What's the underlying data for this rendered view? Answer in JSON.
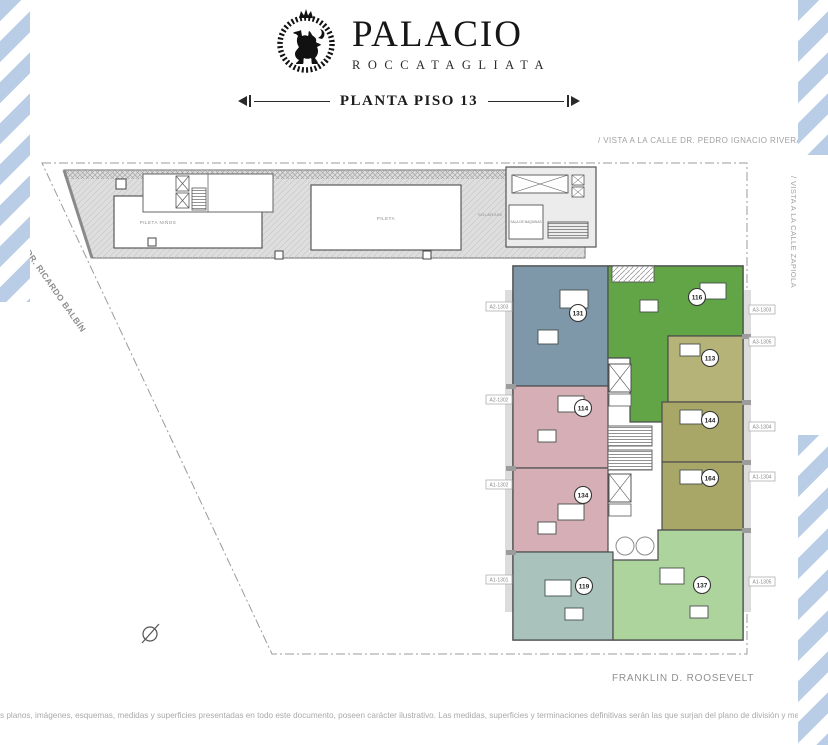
{
  "colors": {
    "stripe-blue": "#b9cde6",
    "ink": "#1d1d1b",
    "muted-gray": "#a0a0a0",
    "terrace-gray": "#dedede"
  },
  "header": {
    "brand_name": "PALACIO",
    "brand_subtitle": "ROCCATAGLIATA",
    "plan_title": "PLANTA PISO 13"
  },
  "streets": {
    "top": "/ VISTA A LA CALLE DR. PEDRO IGNACIO RIVERA",
    "right": "/ VISTA A LA CALLE ZAPIOLA",
    "left": "AV. DR. RICARDO BALBÍN",
    "bottom": "FRANKLIN D. ROOSEVELT"
  },
  "terrace": {
    "kids_pool_label": "PILETA NIÑOS",
    "pool_label": "PILETA",
    "solarium_label": "SOLARIUM",
    "machine_room_label": "SALA DE MAQUINAS"
  },
  "plan": {
    "units": [
      {
        "number": "131",
        "color": "#7e97a9"
      },
      {
        "number": "116",
        "color": "#61a547"
      },
      {
        "number": "113",
        "color": "#b5b377"
      },
      {
        "number": "114",
        "color": "#d5aeb6"
      },
      {
        "number": "144",
        "color": "#a8a768"
      },
      {
        "number": "134",
        "color": "#d5aeb6"
      },
      {
        "number": "164",
        "color": "#a8a768"
      },
      {
        "number": "119",
        "color": "#a9c2bb"
      },
      {
        "number": "137",
        "color": "#aed49d"
      }
    ],
    "left_tags": [
      "A2-1303",
      "A2-1302",
      "A1-1302",
      "A1-1301"
    ],
    "right_tags": [
      "A3-1303",
      "A3-1305",
      "A3-1304",
      "A1-1304",
      "A1-1305"
    ]
  },
  "footer": {
    "disclaimer": "s planos, imágenes, esquemas, medidas y superficies presentadas en todo este documento, poseen carácter ilustrativo.  Las medidas, superficies y terminaciones definitivas serán las que surjan del plano de división y mensura horizontal"
  }
}
